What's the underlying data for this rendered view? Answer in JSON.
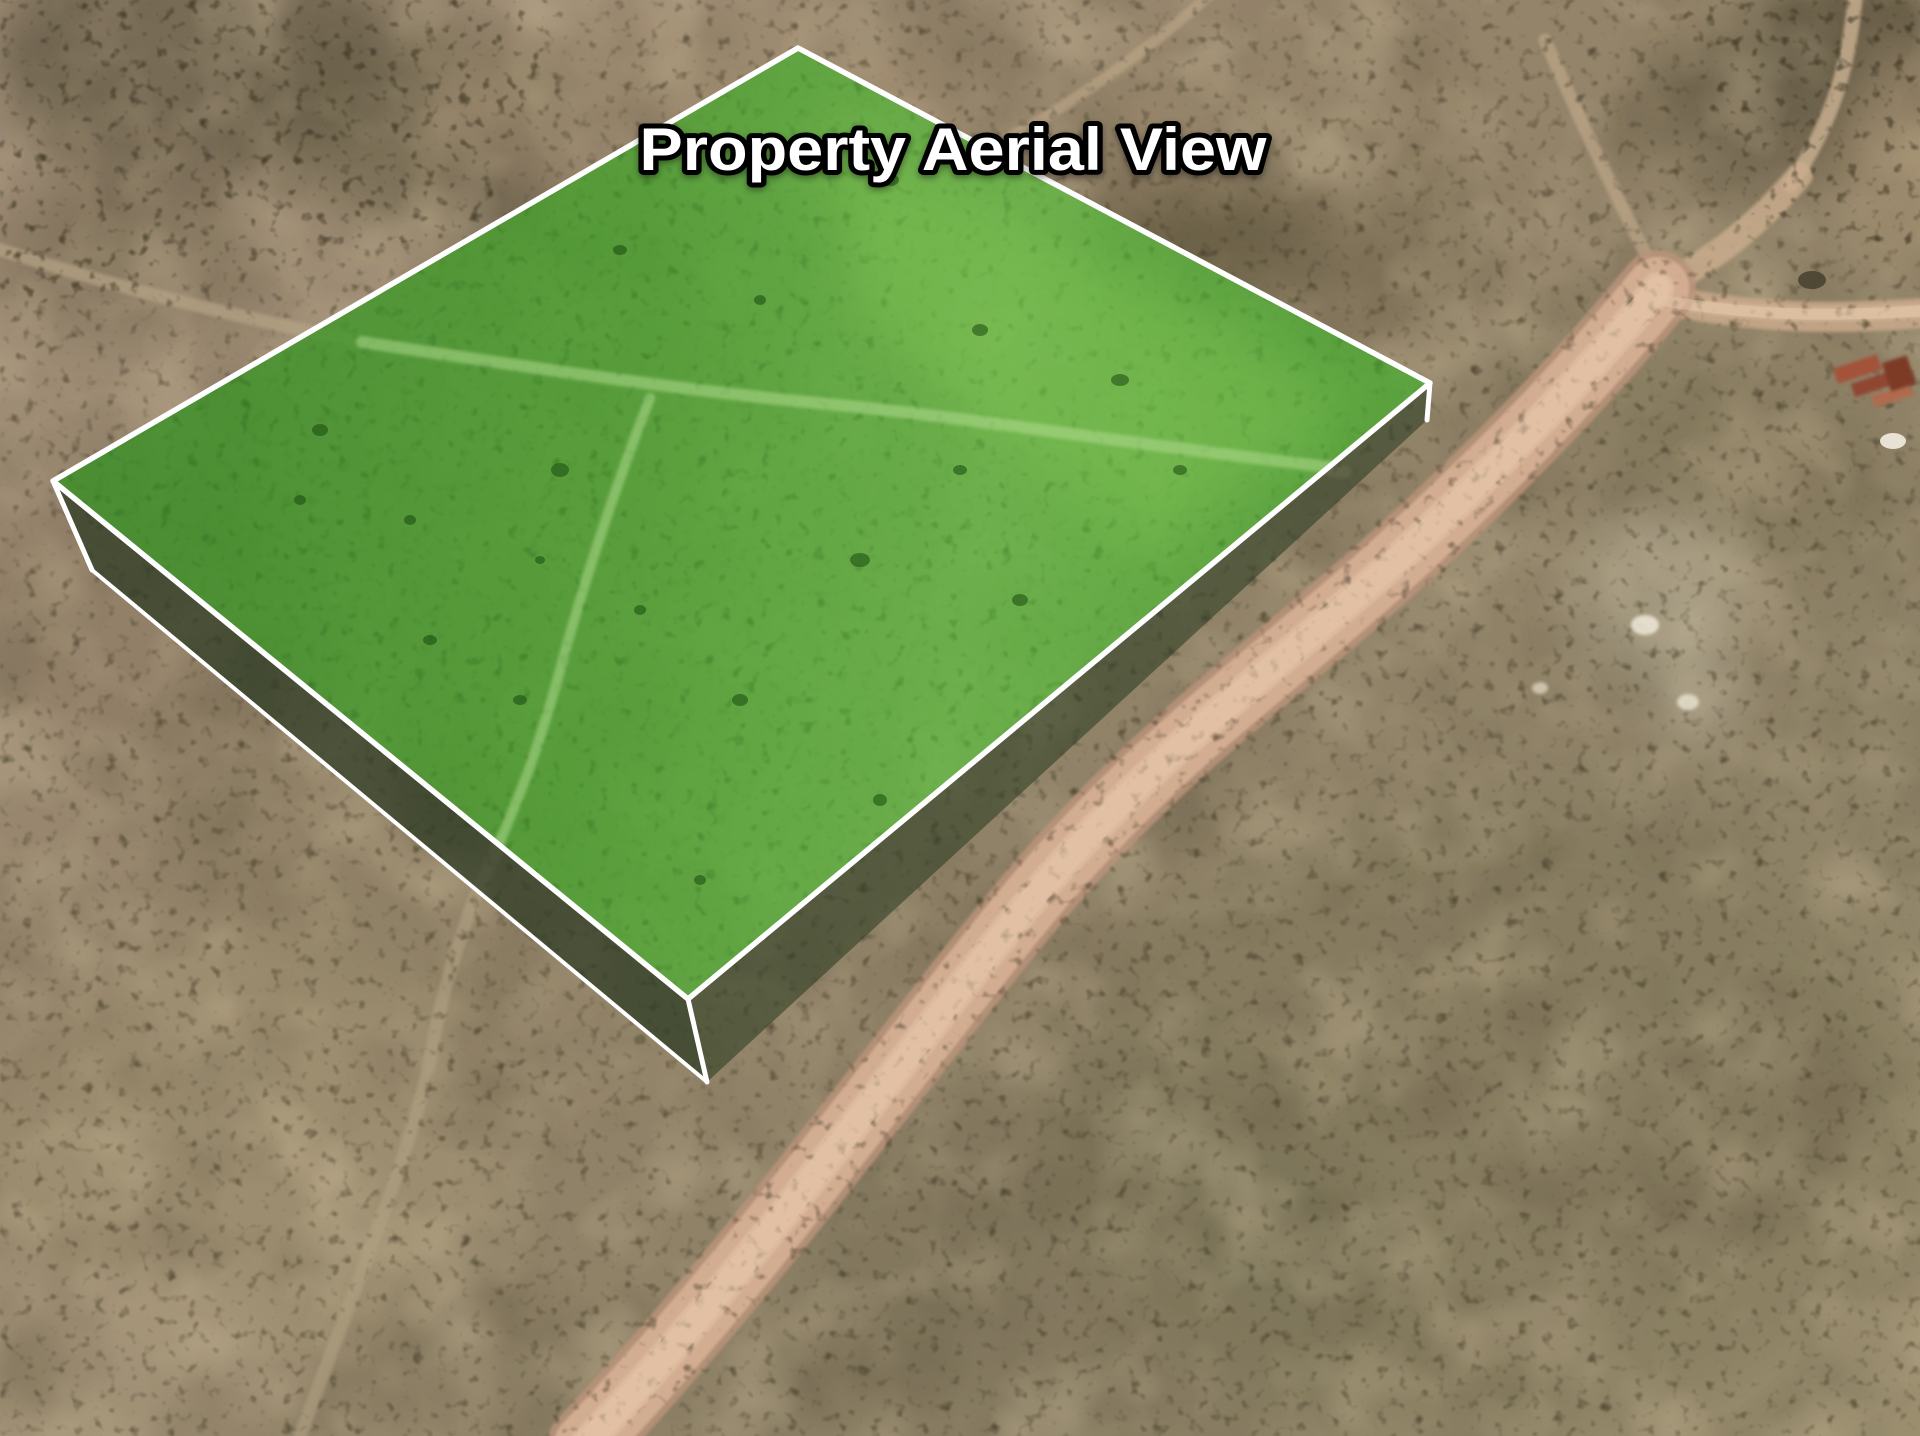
{
  "title": {
    "text": "Property Aerial View",
    "color": "#ffffff",
    "outline": "#000000"
  },
  "scene": {
    "view": "aerial-satellite-3d",
    "parcel": {
      "label": "highlighted property parcel",
      "fill": "#4fa134",
      "edge": "#ffffff"
    },
    "road": {
      "label": "dirt road",
      "color": "#d2ad92"
    },
    "terrain": {
      "base": "#9b8c72",
      "scrub": "#564f38",
      "light_soil": "#cdbc9b",
      "caliche_patch": "#cfc7ae",
      "structure": "#a4523a"
    }
  }
}
